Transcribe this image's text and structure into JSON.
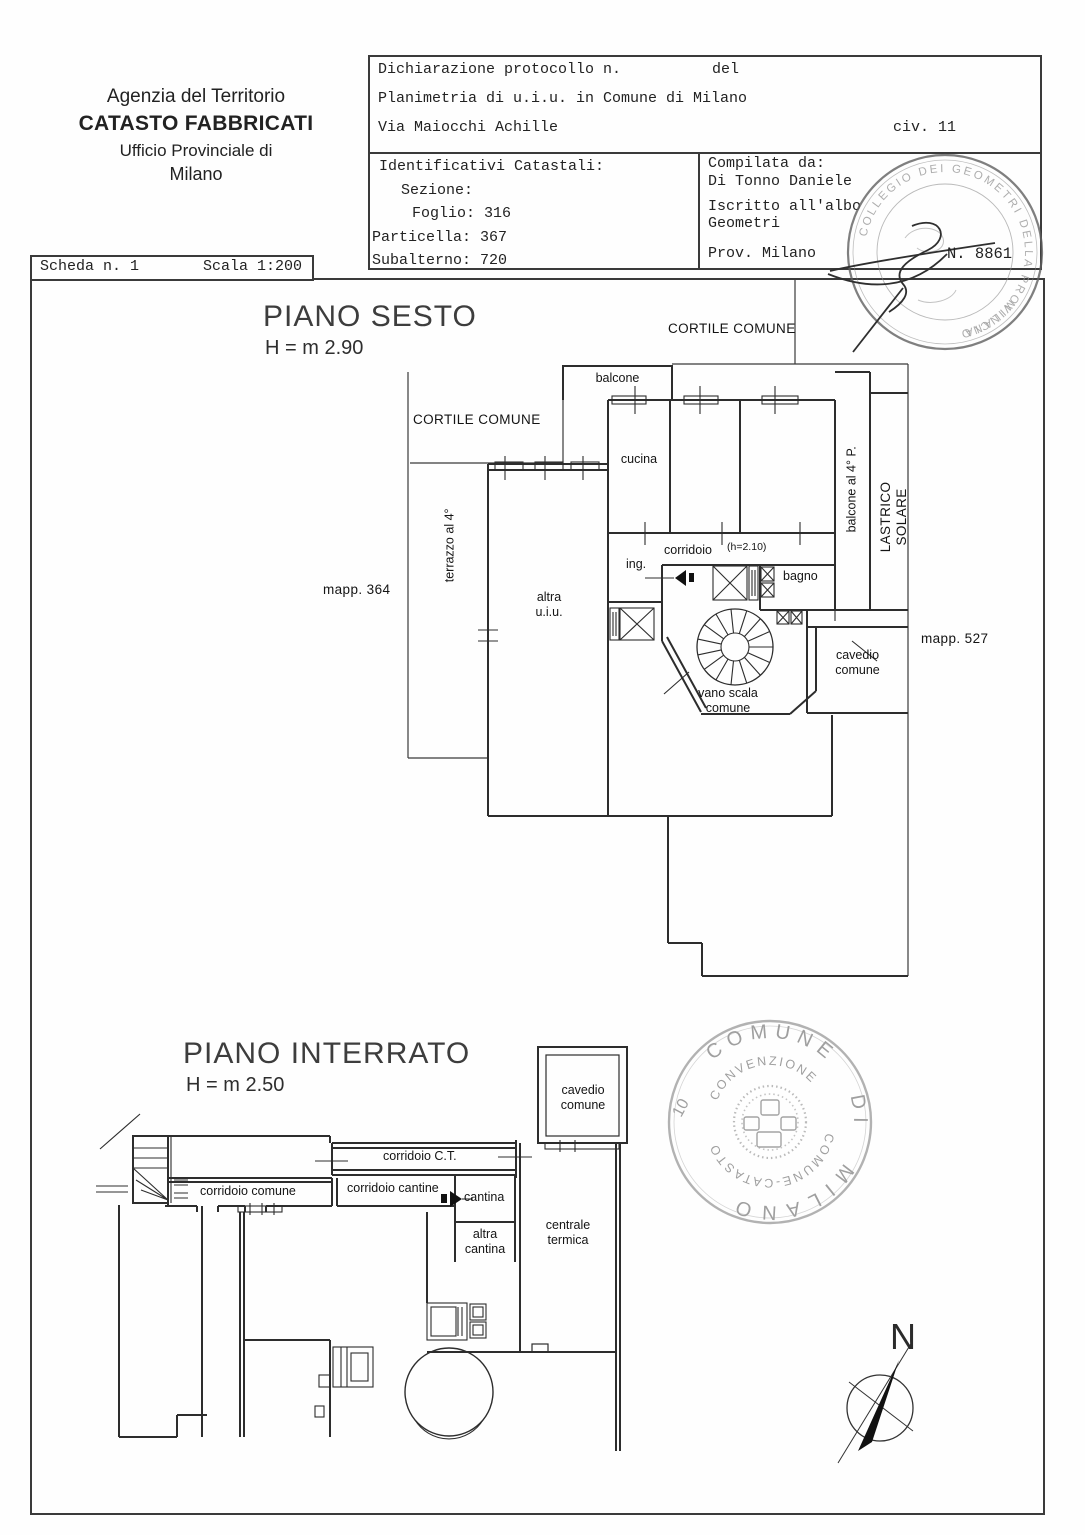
{
  "header": {
    "agency": {
      "line1": "Agenzia del Territorio",
      "line2": "CATASTO FABBRICATI",
      "line3": "Ufficio Provinciale di",
      "line4": "Milano"
    },
    "declaration": {
      "protocol_label": "Dichiarazione protocollo n.",
      "del_label": "del",
      "planimetria": "Planimetria di u.i.u. in Comune di Milano",
      "street": "Via Maiocchi Achille",
      "civic": "civ. 11"
    },
    "identifiers": {
      "title": "Identificativi Catastali:",
      "sezione": "Sezione:",
      "foglio": "Foglio: 316",
      "particella": "Particella: 367",
      "subalterno": "Subalterno: 720"
    },
    "compiler": {
      "title": "Compilata da:",
      "name": "Di Tonno Daniele",
      "albo1": "Iscritto all'albo",
      "albo2": "Geometri",
      "prov": "Prov. Milano",
      "stamp_number": "N. 8861"
    }
  },
  "sheet_bar": {
    "scheda": "Scheda n. 1",
    "scala": "Scala 1:200"
  },
  "piano_sesto": {
    "title": "PIANO SESTO",
    "height": "H = m 2.90",
    "labels": {
      "cortile_top": "CORTILE COMUNE",
      "cortile_left": "CORTILE COMUNE",
      "balcone": "balcone",
      "cucina": "cucina",
      "corridoio": "corridoio",
      "corridoio_h": "(h=2.10)",
      "ing": "ing.",
      "bagno": "bagno",
      "altra_uiu": "altra\nu.i.u.",
      "vano_scala": "vano scala\ncomune",
      "cavedio": "cavedio\ncomune",
      "terrazzo": "terrazzo al 4°",
      "balcone_4p": "balcone al 4° P.",
      "lastrico": "LASTRICO SOLARE",
      "mapp_364": "mapp. 364",
      "mapp_527": "mapp. 527"
    }
  },
  "piano_interrato": {
    "title": "PIANO INTERRATO",
    "height": "H = m 2.50",
    "labels": {
      "cavedio": "cavedio\ncomune",
      "corridoio_ct": "corridoio C.T.",
      "corridoio_comune": "corridoio comune",
      "corridoio_cantine": "corridoio cantine",
      "cantina": "cantina",
      "altra_cantina": "altra\ncantina",
      "centrale": "centrale\ntermica"
    }
  },
  "stamps": {
    "albo": {
      "ring_top": "COLLEGIO DEI GEOMETRI DELLA PROVINCIA",
      "ring_bottom": "MILANO"
    },
    "comune": {
      "word1": "COMUNE",
      "word2": "DI",
      "word3": "MILANO",
      "inner_top": "CONVENZIONE",
      "inner_bottom": "COMUNE-CATASTO",
      "code": "10"
    }
  },
  "compass": {
    "north": "N"
  }
}
